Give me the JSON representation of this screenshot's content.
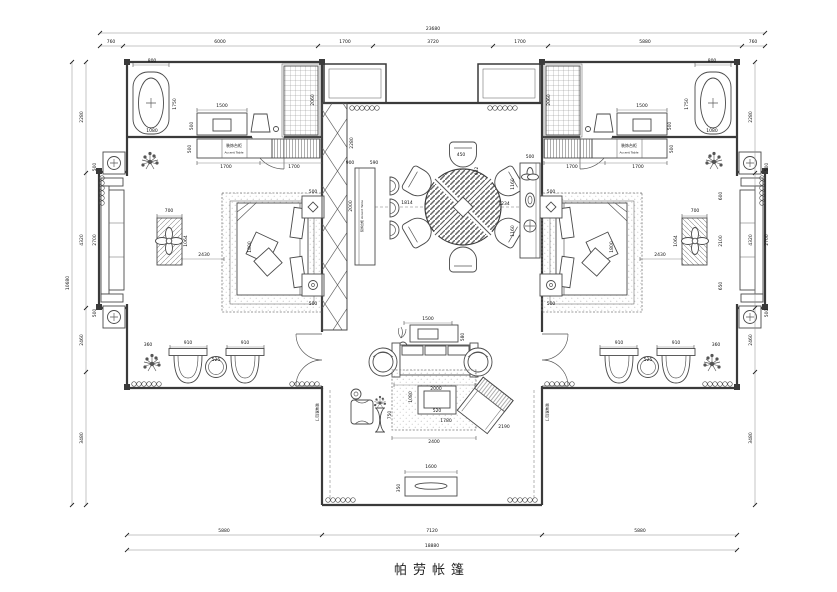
{
  "title": "帕劳帐篷",
  "labels": {
    "accent_table_cn": "装饰台柜",
    "accent_table_en": "Accent Table",
    "hall_console": "装饰台柜 Accent Table",
    "sliding_door": "玻璃推拉门"
  },
  "border_dimensions": {
    "top_total": "23680",
    "top_segments": [
      "760",
      "6000",
      "1700",
      "3720",
      "1700",
      "5880",
      "760"
    ],
    "left_total": "10680",
    "left_segments": [
      "2280",
      "4320",
      "2460",
      "3480"
    ],
    "right_segments": [
      "2280",
      "4320",
      "2460",
      "3480"
    ],
    "bottom_total": "18880",
    "bottom_segments": [
      "5880",
      "7120",
      "5880"
    ]
  },
  "annotations": [
    {
      "t": "23680",
      "x": 433,
      "y": 30
    },
    {
      "t": "760",
      "x": 111,
      "y": 43
    },
    {
      "t": "6000",
      "x": 220,
      "y": 43
    },
    {
      "t": "1700",
      "x": 345,
      "y": 43
    },
    {
      "t": "3720",
      "x": 433,
      "y": 43
    },
    {
      "t": "1700",
      "x": 520,
      "y": 43
    },
    {
      "t": "5880",
      "x": 645,
      "y": 43
    },
    {
      "t": "760",
      "x": 753,
      "y": 43
    },
    {
      "t": "10680",
      "x": 69,
      "y": 283,
      "r": -90
    },
    {
      "t": "2280",
      "x": 83,
      "y": 117,
      "r": -90
    },
    {
      "t": "4320",
      "x": 83,
      "y": 240,
      "r": -90
    },
    {
      "t": "2460",
      "x": 83,
      "y": 340,
      "r": -90
    },
    {
      "t": "3480",
      "x": 83,
      "y": 438,
      "r": -90
    },
    {
      "t": "2280",
      "x": 752,
      "y": 117,
      "r": -90
    },
    {
      "t": "4320",
      "x": 752,
      "y": 240,
      "r": -90
    },
    {
      "t": "2460",
      "x": 752,
      "y": 340,
      "r": -90
    },
    {
      "t": "3480",
      "x": 752,
      "y": 438,
      "r": -90
    },
    {
      "t": "5880",
      "x": 224,
      "y": 532
    },
    {
      "t": "7120",
      "x": 432,
      "y": 532
    },
    {
      "t": "5880",
      "x": 640,
      "y": 532
    },
    {
      "t": "18880",
      "x": 432,
      "y": 547
    },
    {
      "t": "800",
      "x": 152,
      "y": 62
    },
    {
      "t": "1750",
      "x": 176,
      "y": 104,
      "r": -90
    },
    {
      "t": "1080",
      "x": 152,
      "y": 132
    },
    {
      "t": "1500",
      "x": 222,
      "y": 107
    },
    {
      "t": "500",
      "x": 193,
      "y": 126,
      "r": -90
    },
    {
      "t": "2060",
      "x": 314,
      "y": 100,
      "r": -90
    },
    {
      "t": "1700",
      "x": 226,
      "y": 168
    },
    {
      "t": "1700",
      "x": 294,
      "y": 168
    },
    {
      "t": "500",
      "x": 191,
      "y": 149,
      "r": -90
    },
    {
      "t": "700",
      "x": 169,
      "y": 212
    },
    {
      "t": "1064",
      "x": 187,
      "y": 241,
      "r": -90
    },
    {
      "t": "2430",
      "x": 204,
      "y": 256
    },
    {
      "t": "2700",
      "x": 96,
      "y": 240,
      "r": -90
    },
    {
      "t": "500",
      "x": 96,
      "y": 167,
      "r": -90
    },
    {
      "t": "500",
      "x": 96,
      "y": 313,
      "r": -90
    },
    {
      "t": "1800",
      "x": 251,
      "y": 247,
      "r": -90
    },
    {
      "t": "500",
      "x": 313,
      "y": 193
    },
    {
      "t": "500",
      "x": 313,
      "y": 305
    },
    {
      "t": "910",
      "x": 188,
      "y": 344
    },
    {
      "t": "910",
      "x": 245,
      "y": 344
    },
    {
      "t": "525",
      "x": 216,
      "y": 361
    },
    {
      "t": "360",
      "x": 148,
      "y": 346
    },
    {
      "t": "800",
      "x": 712,
      "y": 62
    },
    {
      "t": "1750",
      "x": 688,
      "y": 104,
      "r": -90
    },
    {
      "t": "1080",
      "x": 712,
      "y": 132
    },
    {
      "t": "1500",
      "x": 642,
      "y": 107
    },
    {
      "t": "500",
      "x": 671,
      "y": 126,
      "r": -90
    },
    {
      "t": "2060",
      "x": 550,
      "y": 100,
      "r": -90
    },
    {
      "t": "1700",
      "x": 572,
      "y": 168
    },
    {
      "t": "1700",
      "x": 638,
      "y": 168
    },
    {
      "t": "500",
      "x": 673,
      "y": 149,
      "r": -90
    },
    {
      "t": "700",
      "x": 695,
      "y": 212
    },
    {
      "t": "1064",
      "x": 677,
      "y": 241,
      "r": -90
    },
    {
      "t": "2430",
      "x": 660,
      "y": 256
    },
    {
      "t": "2700",
      "x": 768,
      "y": 240,
      "r": -90
    },
    {
      "t": "500",
      "x": 768,
      "y": 167,
      "r": -90
    },
    {
      "t": "500",
      "x": 768,
      "y": 313,
      "r": -90
    },
    {
      "t": "1800",
      "x": 613,
      "y": 247,
      "r": -90
    },
    {
      "t": "500",
      "x": 551,
      "y": 193
    },
    {
      "t": "500",
      "x": 551,
      "y": 305
    },
    {
      "t": "910",
      "x": 676,
      "y": 344
    },
    {
      "t": "910",
      "x": 619,
      "y": 344
    },
    {
      "t": "525",
      "x": 648,
      "y": 361
    },
    {
      "t": "360",
      "x": 716,
      "y": 346
    },
    {
      "t": "600",
      "x": 722,
      "y": 196,
      "r": -90
    },
    {
      "t": "2100",
      "x": 722,
      "y": 241,
      "r": -90
    },
    {
      "t": "650",
      "x": 722,
      "y": 286,
      "r": -90
    },
    {
      "t": "2280",
      "x": 353,
      "y": 143,
      "r": -90
    },
    {
      "t": "900",
      "x": 350,
      "y": 164
    },
    {
      "t": "590",
      "x": 374,
      "y": 164
    },
    {
      "t": "2000",
      "x": 352,
      "y": 206,
      "r": -90
    },
    {
      "t": "1814",
      "x": 407,
      "y": 204
    },
    {
      "t": "450",
      "x": 461,
      "y": 156
    },
    {
      "t": "932",
      "x": 478,
      "y": 171,
      "r": -90
    },
    {
      "t": "1160",
      "x": 514,
      "y": 184,
      "r": -90
    },
    {
      "t": "1234",
      "x": 504,
      "y": 205
    },
    {
      "t": "1160",
      "x": 514,
      "y": 231,
      "r": -90
    },
    {
      "t": "500",
      "x": 530,
      "y": 158
    },
    {
      "t": "装饰台柜 Accent Table",
      "x": 363,
      "y": 216,
      "r": -90,
      "s": 3,
      "n": "hall-console-label"
    },
    {
      "t": "1500",
      "x": 428,
      "y": 320
    },
    {
      "t": "580",
      "x": 464,
      "y": 337,
      "r": -90
    },
    {
      "t": "2000",
      "x": 436,
      "y": 390
    },
    {
      "t": "1080",
      "x": 412,
      "y": 397,
      "r": -90
    },
    {
      "t": "520",
      "x": 437,
      "y": 412
    },
    {
      "t": "1780",
      "x": 446,
      "y": 422
    },
    {
      "t": "2400",
      "x": 434,
      "y": 443
    },
    {
      "t": "2190",
      "x": 504,
      "y": 428
    },
    {
      "t": "750",
      "x": 391,
      "y": 415,
      "r": -90
    },
    {
      "t": "1600",
      "x": 431,
      "y": 468
    },
    {
      "t": "350",
      "x": 400,
      "y": 488,
      "r": -90
    },
    {
      "t": "装饰台柜",
      "x": 234,
      "y": 147,
      "s": 4,
      "n": "accent-table-label-cn"
    },
    {
      "t": "Accent Table",
      "x": 234,
      "y": 153.5,
      "s": 3,
      "n": "accent-table-label-en"
    },
    {
      "t": "装饰台柜",
      "x": 629,
      "y": 147,
      "s": 4,
      "n": "accent-table-label-cn"
    },
    {
      "t": "Accent Table",
      "x": 629,
      "y": 153.5,
      "s": 3,
      "n": "accent-table-label-en"
    },
    {
      "t": "玻璃推拉门",
      "x": 316,
      "y": 412,
      "r": 90,
      "s": 3.5,
      "n": "door-label"
    },
    {
      "t": "玻璃推拉门",
      "x": 546,
      "y": 412,
      "r": 90,
      "s": 3.5,
      "n": "door-label"
    }
  ]
}
